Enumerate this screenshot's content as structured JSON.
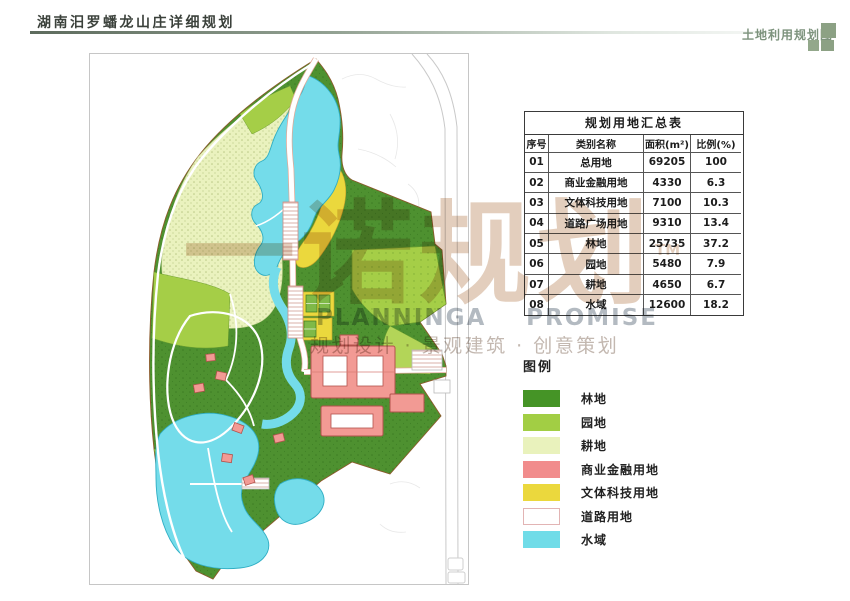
{
  "header": {
    "title": "湖南汨罗蟠龙山庄详细规划",
    "corner_label": "土地利用规划图"
  },
  "table": {
    "title": "规划用地汇总表",
    "columns": [
      "序号",
      "类别名称",
      "面积(m²)",
      "比例(%)"
    ],
    "rows": [
      [
        "01",
        "总用地",
        "69205",
        "100"
      ],
      [
        "02",
        "商业金融用地",
        "4330",
        "6.3"
      ],
      [
        "03",
        "文体科技用地",
        "7100",
        "10.3"
      ],
      [
        "04",
        "道路广场用地",
        "9310",
        "13.4"
      ],
      [
        "05",
        "林地",
        "25735",
        "37.2"
      ],
      [
        "06",
        "园地",
        "5480",
        "7.9"
      ],
      [
        "07",
        "耕地",
        "4650",
        "6.7"
      ],
      [
        "08",
        "水域",
        "12600",
        "18.2"
      ]
    ]
  },
  "legend": {
    "title": "图例",
    "items": [
      {
        "label": "林地",
        "color": "#459426"
      },
      {
        "label": "园地",
        "color": "#A2CE44"
      },
      {
        "label": "耕地",
        "color": "#E9F2BC"
      },
      {
        "label": "商业金融用地",
        "color": "#F18C8C"
      },
      {
        "label": "文体科技用地",
        "color": "#EBD83D"
      },
      {
        "label": "道路用地",
        "color": "#FFFFFF",
        "border": "#E2B4B4"
      },
      {
        "label": "水域",
        "color": "#70DCE8"
      }
    ]
  },
  "watermark": {
    "brand": "一诺规划",
    "tm": "TM",
    "en_word1": "PLANNINGA",
    "en_word2": "PROMISE",
    "tagline": "规划设计 · 景观建筑 · 创意策划"
  },
  "map": {
    "colors": {
      "forest": "#4E9130",
      "garden": "#A5CE47",
      "farmland": "#EAF2BE",
      "commercial": "#F29A94",
      "culture": "#EBD83D",
      "road": "#FFFFFF",
      "water": "#74DCEA"
    }
  }
}
